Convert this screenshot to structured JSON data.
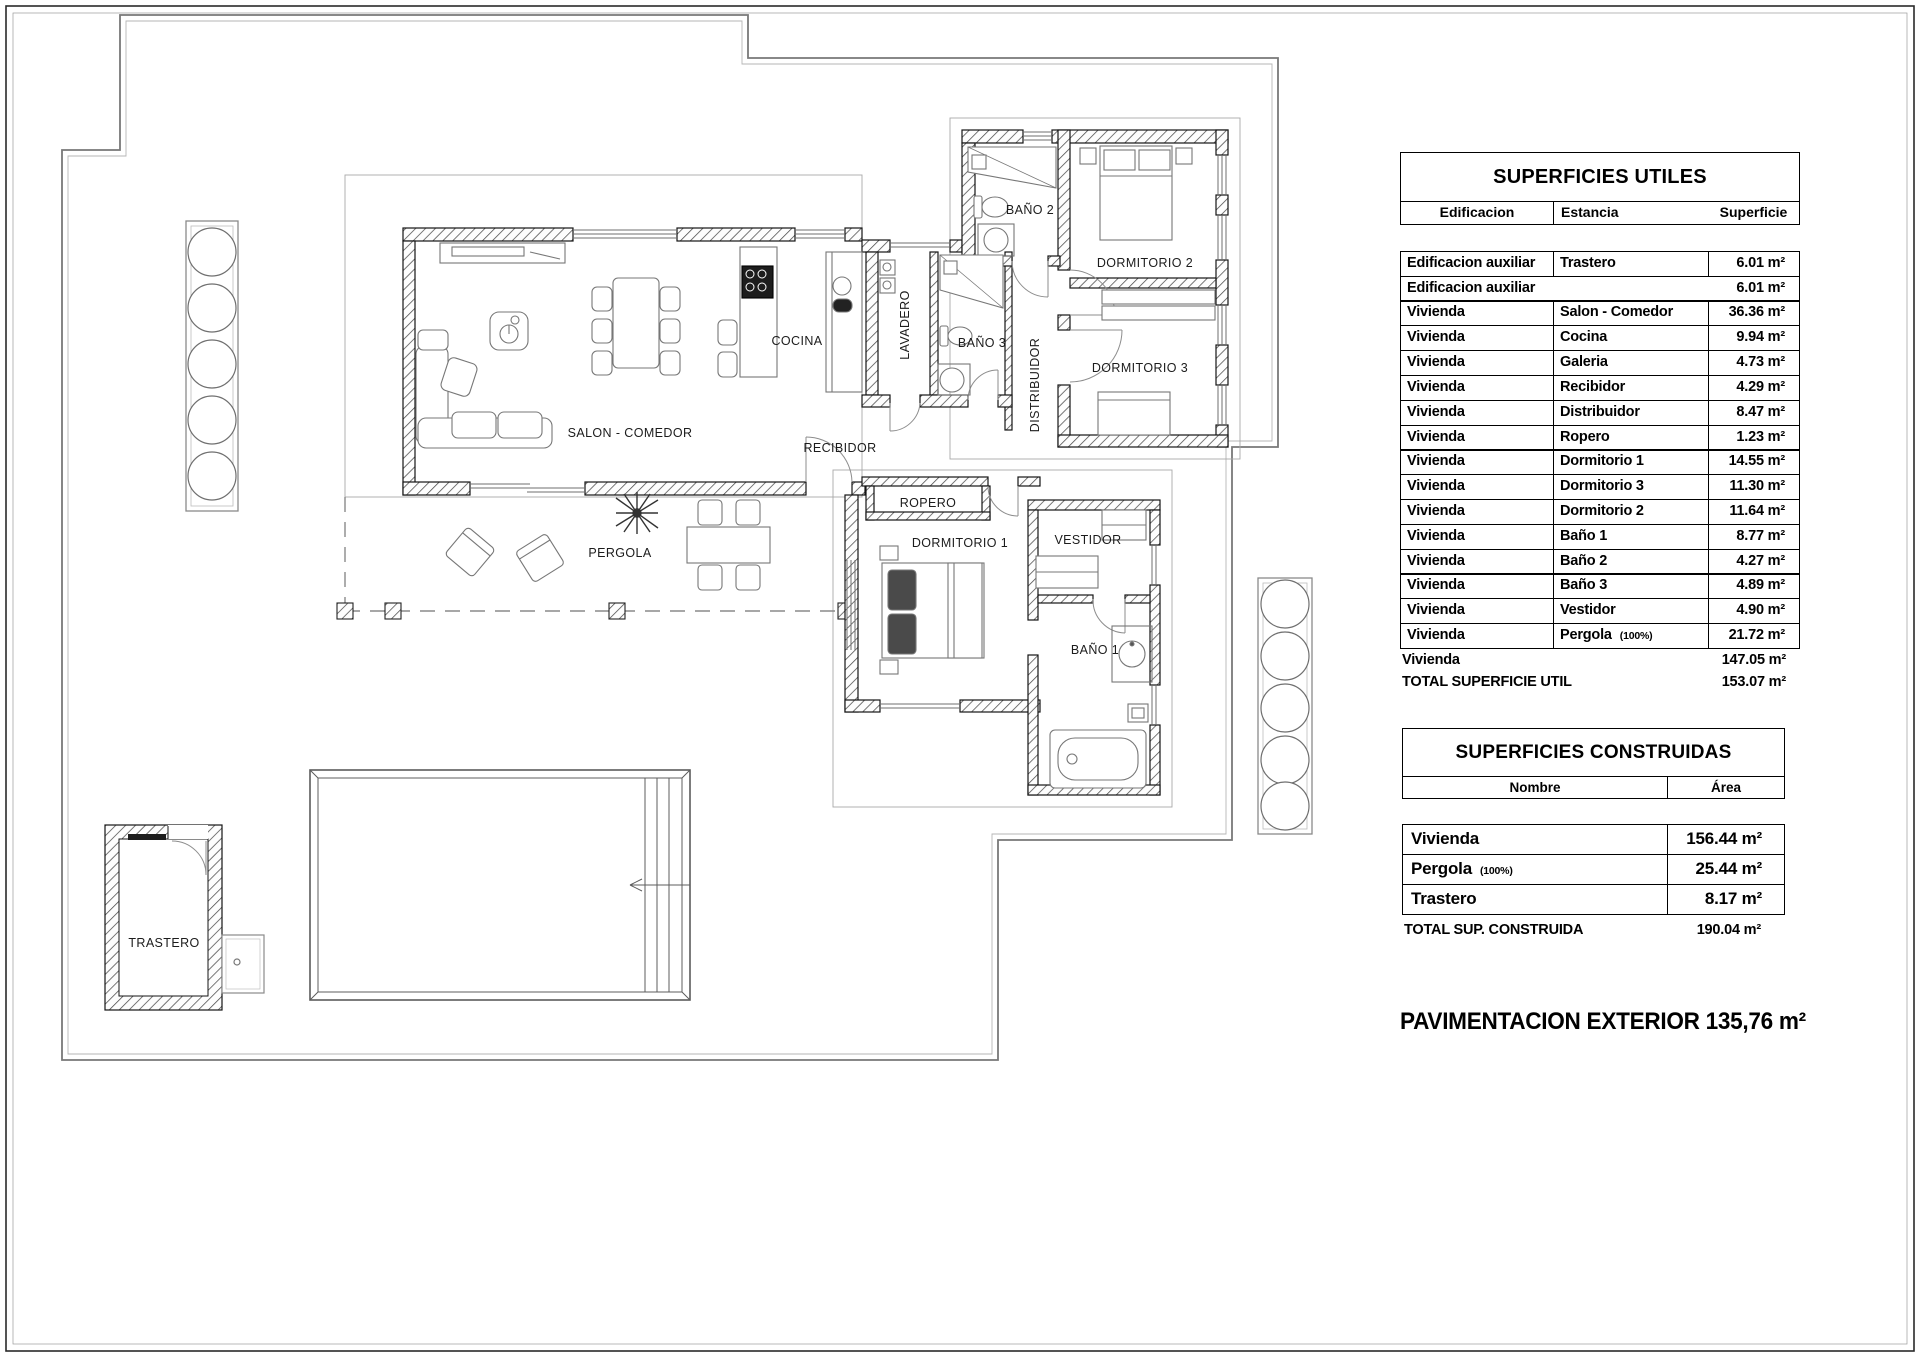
{
  "plan": {
    "rooms": {
      "salon": "SALON - COMEDOR",
      "cocina": "COCINA",
      "lavadero": "LAVADERO",
      "bano2": "BAÑO 2",
      "bano3": "BAÑO 3",
      "distribuidor": "DISTRIBUIDOR",
      "dormitorio2": "DORMITORIO 2",
      "dormitorio3": "DORMITORIO 3",
      "recibidor": "RECIBIDOR",
      "ropero": "ROPERO",
      "dormitorio1": "DORMITORIO 1",
      "vestidor": "VESTIDOR",
      "bano1": "BAÑO 1",
      "pergola": "PERGOLA",
      "trastero": "TRASTERO"
    }
  },
  "tables": {
    "utiles": {
      "title": "SUPERFICIES UTILES",
      "columns": [
        "Edificacion",
        "Estancia",
        "Superficie"
      ],
      "rows": [
        {
          "edificacion": "Edificacion auxiliar",
          "estancia": "Trastero",
          "nota": "",
          "superficie": "6.01 m²"
        },
        {
          "edificacion": "Edificacion auxiliar",
          "estancia": "",
          "nota": "",
          "superficie": "6.01 m²",
          "nosep": true
        },
        {
          "edificacion": "Vivienda",
          "estancia": "Salon - Comedor",
          "nota": "",
          "superficie": "36.36 m²"
        },
        {
          "edificacion": "Vivienda",
          "estancia": "Cocina",
          "nota": "",
          "superficie": "9.94 m²"
        },
        {
          "edificacion": "Vivienda",
          "estancia": "Galeria",
          "nota": "",
          "superficie": "4.73 m²"
        },
        {
          "edificacion": "Vivienda",
          "estancia": "Recibidor",
          "nota": "",
          "superficie": "4.29 m²"
        },
        {
          "edificacion": "Vivienda",
          "estancia": "Distribuidor",
          "nota": "",
          "superficie": "8.47 m²"
        },
        {
          "edificacion": "Vivienda",
          "estancia": "Ropero",
          "nota": "",
          "superficie": "1.23 m²"
        },
        {
          "edificacion": "Vivienda",
          "estancia": "Dormitorio 1",
          "nota": "",
          "superficie": "14.55 m²"
        },
        {
          "edificacion": "Vivienda",
          "estancia": "Dormitorio 3",
          "nota": "",
          "superficie": "11.30 m²"
        },
        {
          "edificacion": "Vivienda",
          "estancia": "Dormitorio 2",
          "nota": "",
          "superficie": "11.64 m²"
        },
        {
          "edificacion": "Vivienda",
          "estancia": "Baño 1",
          "nota": "",
          "superficie": "8.77 m²"
        },
        {
          "edificacion": "Vivienda",
          "estancia": "Baño 2",
          "nota": "",
          "superficie": "4.27 m²"
        },
        {
          "edificacion": "Vivienda",
          "estancia": "Baño 3",
          "nota": "",
          "superficie": "4.89 m²"
        },
        {
          "edificacion": "Vivienda",
          "estancia": "Vestidor",
          "nota": "",
          "superficie": "4.90 m²"
        },
        {
          "edificacion": "Vivienda",
          "estancia": "Pergola",
          "nota": "(100%)",
          "superficie": "21.72 m²"
        }
      ],
      "summary_rows": [
        {
          "label": "Vivienda",
          "value": "147.05 m²"
        },
        {
          "label": "TOTAL SUPERFICIE UTIL",
          "value": "153.07 m²"
        }
      ]
    },
    "construidas": {
      "title": "SUPERFICIES CONSTRUIDAS",
      "columns": [
        "Nombre",
        "Área"
      ],
      "rows": [
        {
          "nombre": "Vivienda",
          "nota": "",
          "area": "156.44 m²"
        },
        {
          "nombre": "Pergola",
          "nota": "(100%)",
          "area": "25.44 m²"
        },
        {
          "nombre": "Trastero",
          "nota": "",
          "area": "8.17 m²"
        }
      ],
      "total": {
        "label": "TOTAL SUP. CONSTRUIDA",
        "value": "190.04 m²"
      }
    }
  },
  "footer": {
    "exterior_paving": "PAVIMENTACION EXTERIOR 135,76 m²"
  }
}
